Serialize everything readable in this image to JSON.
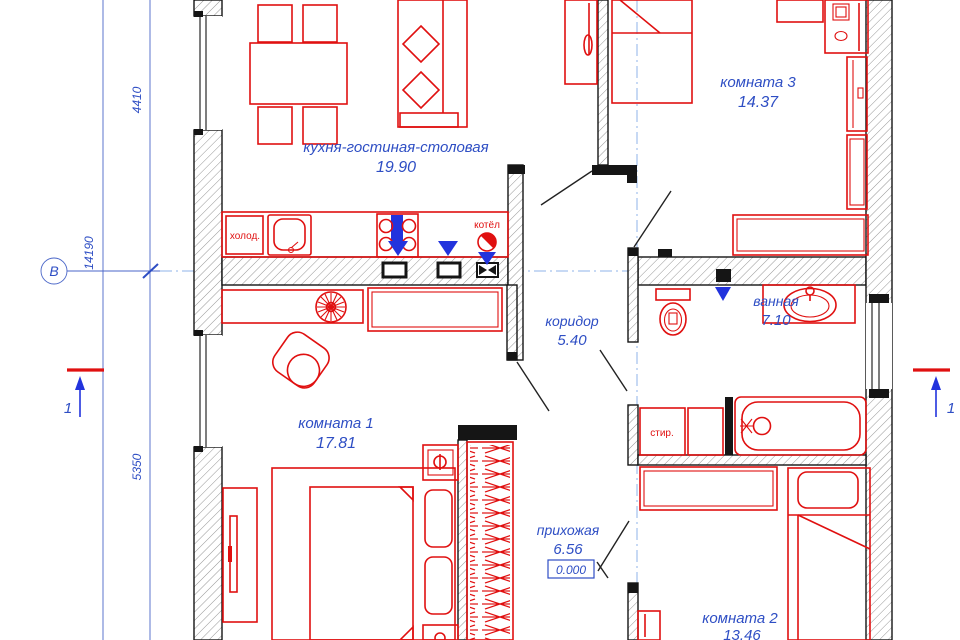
{
  "rooms": {
    "kitchen": {
      "name": "кухня-гостиная-столовая",
      "area": "19.90"
    },
    "room3": {
      "name": "комната 3",
      "area": "14.37"
    },
    "corridor": {
      "name": "коридор",
      "area": "5.40"
    },
    "bathroom": {
      "name": "ванная",
      "area": "7.10"
    },
    "room1": {
      "name": "комната 1",
      "area": "17.81"
    },
    "hallway": {
      "name": "прихожая",
      "area": "6.56"
    },
    "room2": {
      "name": "комната 2",
      "area": "13.46"
    }
  },
  "appliances": {
    "fridge": "холод.",
    "boiler": "котёл",
    "washer": "стир."
  },
  "dimensions": {
    "total_height": "14190",
    "kitchen_depth": "4410",
    "room1_depth": "5350"
  },
  "markers": {
    "axis_label": "В",
    "section_label": "1",
    "elevation": "0.000"
  },
  "colors": {
    "furniture_red": "#e01010",
    "label_blue": "#2e4ec4",
    "dim_blue": "#4a66c8",
    "axis_blue": "#8fb3e8",
    "marker_blue": "#2233dd",
    "wall_black": "#151515"
  }
}
